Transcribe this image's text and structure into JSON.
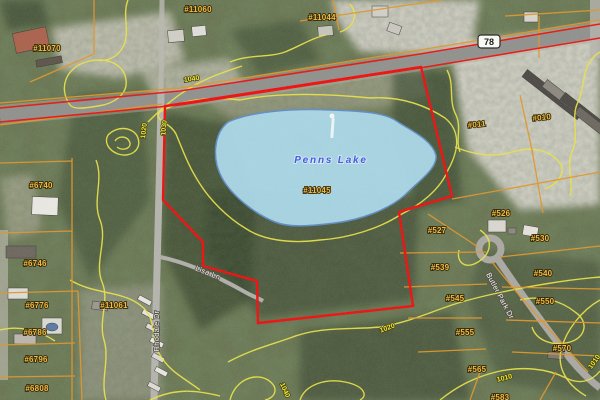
{
  "map": {
    "lake": {
      "name": "Penns Lake"
    },
    "highway_shield": "78",
    "parcels": [
      {
        "text": "#11070"
      },
      {
        "text": "#11060"
      },
      {
        "text": "#11044"
      },
      {
        "text": "#011"
      },
      {
        "text": "#010"
      },
      {
        "text": "#526"
      },
      {
        "text": "#527"
      },
      {
        "text": "#530"
      },
      {
        "text": "#539"
      },
      {
        "text": "#540"
      },
      {
        "text": "#545"
      },
      {
        "text": "#550"
      },
      {
        "text": "#555"
      },
      {
        "text": "#570"
      },
      {
        "text": "#565"
      },
      {
        "text": "#583"
      },
      {
        "text": "#6740"
      },
      {
        "text": "#6746"
      },
      {
        "text": "#6776"
      },
      {
        "text": "#6786"
      },
      {
        "text": "#6796"
      },
      {
        "text": "#6808"
      },
      {
        "text": "#11061"
      },
      {
        "text": "#11045"
      }
    ],
    "contours": [
      {
        "text": "1040"
      },
      {
        "text": "1020"
      },
      {
        "text": "1030"
      },
      {
        "text": "1020"
      },
      {
        "text": "1010"
      },
      {
        "text": "1040"
      },
      {
        "text": "1010"
      }
    ],
    "roads": {
      "rhodale": "Rhodale Dr",
      "lisa": "Lisa Ln",
      "butler": "Butler Park Dr"
    },
    "colors": {
      "selection_boundary": "#ee0c0c",
      "parcel_line": "#dd9428",
      "contour_line": "#e8e144",
      "lake_fill": "#a9d7e8",
      "lake_outline": "#5d8cc9",
      "parcel_label": "#f2b93c"
    }
  }
}
